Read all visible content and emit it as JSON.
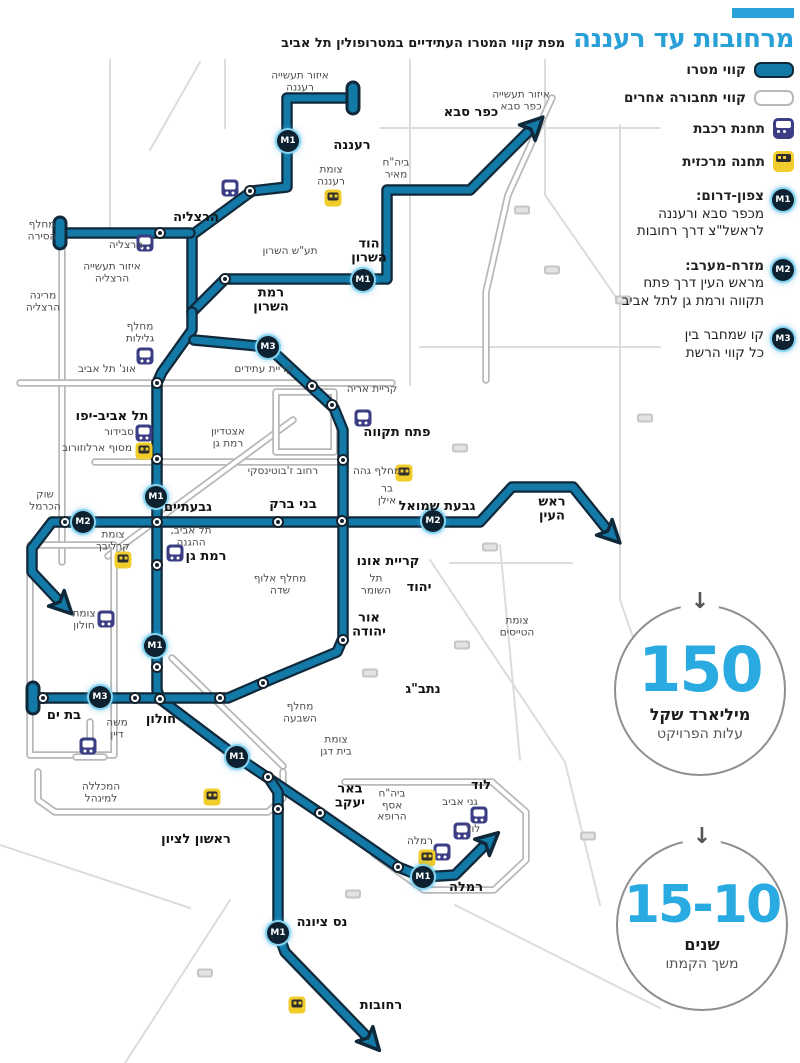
{
  "title": {
    "main": "מרחובות עד רעננה",
    "sub": "מפת קווי המטרו העתידיים במטרופולין תל אביב"
  },
  "legend": {
    "metro_label": "קווי מטרו",
    "other_label": "קווי תחבורה אחרים",
    "train_label": "תחנת רכבת",
    "central_label": "תחנה מרכזית",
    "lines": [
      {
        "badge": "M1",
        "title": "צפון-דרום:",
        "desc": "מכפר סבא ורעננה\nלראשל\"צ דרך רחובות"
      },
      {
        "badge": "M2",
        "title": "מזרח-מערב:",
        "desc": "מראש העין דרך פתח\nתקווה ורמת גן לתל אביב"
      },
      {
        "badge": "M3",
        "title": "",
        "desc": "קו שמחבר בין\nכל קווי הרשת"
      }
    ]
  },
  "stats": [
    {
      "arrow": "↓",
      "value": "150",
      "bold": "מיליארד שקל",
      "sub": "עלות הפרויקט"
    },
    {
      "arrow": "↓",
      "value": "15-10",
      "bold": "שנים",
      "sub": "משך הקמתו"
    }
  ],
  "colors": {
    "metro": "#1379a7",
    "metro_outline": "#10293a",
    "other_line": "#b8b8b8",
    "background_road": "#dcdcdc",
    "accent_blue": "#29a0d8",
    "stat_number": "#29abe2",
    "train_icon_bg": "#3b3d85",
    "central_icon_bg": "#f0cd2a"
  },
  "map": {
    "labels": [
      {
        "t": "איזור תעשייה\nרעננה",
        "x": 300,
        "y": 82,
        "s": "place"
      },
      {
        "t": "איזור תעשייה\nכפר סבא",
        "x": 521,
        "y": 101,
        "s": "place"
      },
      {
        "t": "כפר סבא",
        "x": 471,
        "y": 113,
        "s": "city"
      },
      {
        "t": "רעננה",
        "x": 352,
        "y": 146,
        "s": "city"
      },
      {
        "t": "צומת\nרעננה",
        "x": 331,
        "y": 176,
        "s": "place"
      },
      {
        "t": "ביה\"ח\nמאיר",
        "x": 396,
        "y": 169,
        "s": "place"
      },
      {
        "t": "הרצליה",
        "x": 196,
        "y": 218,
        "s": "city"
      },
      {
        "t": "מחלף\nהסירה",
        "x": 42,
        "y": 231,
        "s": "place"
      },
      {
        "t": "הרצליה",
        "x": 126,
        "y": 246,
        "s": "place"
      },
      {
        "t": "תע\"ש השרון",
        "x": 290,
        "y": 252,
        "s": "place"
      },
      {
        "t": "הוד\nהשרון",
        "x": 369,
        "y": 252,
        "s": "city"
      },
      {
        "t": "איזור תעשייה\nהרצליה",
        "x": 112,
        "y": 273,
        "s": "place"
      },
      {
        "t": "רמת\nהשרון",
        "x": 271,
        "y": 301,
        "s": "city"
      },
      {
        "t": "מרינה\nהרצליה",
        "x": 43,
        "y": 302,
        "s": "place"
      },
      {
        "t": "מחלף\nגלילות",
        "x": 140,
        "y": 333,
        "s": "place"
      },
      {
        "t": "קריית עתידים",
        "x": 264,
        "y": 370,
        "s": "place"
      },
      {
        "t": "אונ' תל אביב",
        "x": 107,
        "y": 370,
        "s": "place"
      },
      {
        "t": "קריית אריה",
        "x": 372,
        "y": 390,
        "s": "place"
      },
      {
        "t": "תל אביב-יפו",
        "x": 112,
        "y": 417,
        "s": "city"
      },
      {
        "t": "פתח תקווה",
        "x": 397,
        "y": 433,
        "s": "city"
      },
      {
        "t": "סבידור",
        "x": 119,
        "y": 433,
        "s": "place"
      },
      {
        "t": "מסוף ארלוזורוב",
        "x": 97,
        "y": 449,
        "s": "place"
      },
      {
        "t": "אצטדיון\nרמת גן",
        "x": 228,
        "y": 438,
        "s": "place"
      },
      {
        "t": "רחוב ז'בוטינסקי",
        "x": 283,
        "y": 472,
        "s": "place"
      },
      {
        "t": "מחלף גהה",
        "x": 377,
        "y": 472,
        "s": "place"
      },
      {
        "t": "בר\nאילן",
        "x": 387,
        "y": 495,
        "s": "place"
      },
      {
        "t": "גבעתיים",
        "x": 188,
        "y": 508,
        "s": "city"
      },
      {
        "t": "בני ברק",
        "x": 293,
        "y": 505,
        "s": "city"
      },
      {
        "t": "גבעת שמואל",
        "x": 437,
        "y": 507,
        "s": "city"
      },
      {
        "t": "ראש\nהעין",
        "x": 552,
        "y": 510,
        "s": "city"
      },
      {
        "t": "שוק\nהכרמל",
        "x": 45,
        "y": 501,
        "s": "place"
      },
      {
        "t": "צומת\nקרליבך",
        "x": 113,
        "y": 541,
        "s": "place"
      },
      {
        "t": "תל אביב,\nההגנה",
        "x": 191,
        "y": 537,
        "s": "place"
      },
      {
        "t": "רמת גן",
        "x": 206,
        "y": 557,
        "s": "city"
      },
      {
        "t": "קריית אונו",
        "x": 388,
        "y": 562,
        "s": "city"
      },
      {
        "t": "יהוד",
        "x": 419,
        "y": 588,
        "s": "city"
      },
      {
        "t": "תל\nהשומר",
        "x": 376,
        "y": 585,
        "s": "place"
      },
      {
        "t": "מחלף אלוף\nשדה",
        "x": 280,
        "y": 585,
        "s": "place"
      },
      {
        "t": "אור\nיהודה",
        "x": 369,
        "y": 626,
        "s": "city"
      },
      {
        "t": "צומת\nהטייסים",
        "x": 517,
        "y": 627,
        "s": "place"
      },
      {
        "t": "צומת\nחולון",
        "x": 84,
        "y": 620,
        "s": "place"
      },
      {
        "t": "בת ים",
        "x": 64,
        "y": 716,
        "s": "city"
      },
      {
        "t": "חולון",
        "x": 161,
        "y": 720,
        "s": "city"
      },
      {
        "t": "נתב\"ג",
        "x": 423,
        "y": 690,
        "s": "city"
      },
      {
        "t": "מחלף\nהשבעה",
        "x": 300,
        "y": 713,
        "s": "place"
      },
      {
        "t": "צומת\nבית דגן",
        "x": 336,
        "y": 746,
        "s": "place"
      },
      {
        "t": "משה\nדיין",
        "x": 117,
        "y": 729,
        "s": "place"
      },
      {
        "t": "המכללה\nלמינהל",
        "x": 101,
        "y": 793,
        "s": "place"
      },
      {
        "t": "ראשון לציון",
        "x": 196,
        "y": 840,
        "s": "city"
      },
      {
        "t": "באר\nיעקב",
        "x": 350,
        "y": 797,
        "s": "city"
      },
      {
        "t": "ביה\"ח\nאסף\nהרופא",
        "x": 392,
        "y": 806,
        "s": "place"
      },
      {
        "t": "לוד",
        "x": 481,
        "y": 786,
        "s": "city"
      },
      {
        "t": "גני אביב",
        "x": 460,
        "y": 803,
        "s": "place"
      },
      {
        "t": "לוד",
        "x": 473,
        "y": 830,
        "s": "place"
      },
      {
        "t": "רמלה",
        "x": 420,
        "y": 842,
        "s": "place"
      },
      {
        "t": "רמלה",
        "x": 466,
        "y": 888,
        "s": "city"
      },
      {
        "t": "נס ציונה",
        "x": 322,
        "y": 923,
        "s": "city"
      },
      {
        "t": "רחובות",
        "x": 381,
        "y": 1006,
        "s": "city"
      }
    ],
    "badges": [
      {
        "t": "M1",
        "x": 288,
        "y": 141
      },
      {
        "t": "M1",
        "x": 363,
        "y": 280
      },
      {
        "t": "M1",
        "x": 156,
        "y": 497
      },
      {
        "t": "M1",
        "x": 155,
        "y": 646
      },
      {
        "t": "M1",
        "x": 237,
        "y": 757
      },
      {
        "t": "M1",
        "x": 423,
        "y": 877
      },
      {
        "t": "M1",
        "x": 278,
        "y": 933
      },
      {
        "t": "M2",
        "x": 83,
        "y": 522
      },
      {
        "t": "M2",
        "x": 433,
        "y": 521
      },
      {
        "t": "M3",
        "x": 268,
        "y": 347
      },
      {
        "t": "M3",
        "x": 100,
        "y": 697
      }
    ],
    "stations": [
      [
        250,
        191
      ],
      [
        160,
        233
      ],
      [
        225,
        279
      ],
      [
        157,
        383
      ],
      [
        157,
        459
      ],
      [
        157,
        522
      ],
      [
        157,
        565
      ],
      [
        157,
        667
      ],
      [
        160,
        699
      ],
      [
        135,
        698
      ],
      [
        43,
        698
      ],
      [
        220,
        698
      ],
      [
        263,
        683
      ],
      [
        65,
        522
      ],
      [
        278,
        522
      ],
      [
        342,
        521
      ],
      [
        343,
        460
      ],
      [
        332,
        405
      ],
      [
        312,
        386
      ],
      [
        343,
        640
      ],
      [
        268,
        777
      ],
      [
        278,
        809
      ],
      [
        320,
        813
      ],
      [
        398,
        867
      ]
    ],
    "icons": [
      {
        "k": "train",
        "x": 145,
        "y": 243
      },
      {
        "k": "train",
        "x": 230,
        "y": 188
      },
      {
        "k": "train",
        "x": 145,
        "y": 356
      },
      {
        "k": "train",
        "x": 144,
        "y": 433
      },
      {
        "k": "train",
        "x": 175,
        "y": 553
      },
      {
        "k": "train",
        "x": 363,
        "y": 418
      },
      {
        "k": "train",
        "x": 106,
        "y": 619
      },
      {
        "k": "train",
        "x": 88,
        "y": 746
      },
      {
        "k": "train",
        "x": 442,
        "y": 852
      },
      {
        "k": "train",
        "x": 462,
        "y": 831
      },
      {
        "k": "train",
        "x": 479,
        "y": 815
      },
      {
        "k": "bus",
        "x": 333,
        "y": 198
      },
      {
        "k": "bus",
        "x": 144,
        "y": 451
      },
      {
        "k": "bus",
        "x": 123,
        "y": 560
      },
      {
        "k": "bus",
        "x": 404,
        "y": 473
      },
      {
        "k": "bus",
        "x": 212,
        "y": 797
      },
      {
        "k": "bus",
        "x": 427,
        "y": 858
      },
      {
        "k": "bus",
        "x": 297,
        "y": 1005
      }
    ],
    "road_badges": [
      [
        522,
        210
      ],
      [
        552,
        270
      ],
      [
        460,
        448
      ],
      [
        490,
        547
      ],
      [
        462,
        645
      ],
      [
        370,
        673
      ],
      [
        353,
        894
      ],
      [
        205,
        973
      ],
      [
        645,
        418
      ],
      [
        588,
        836
      ],
      [
        623,
        300
      ]
    ]
  }
}
